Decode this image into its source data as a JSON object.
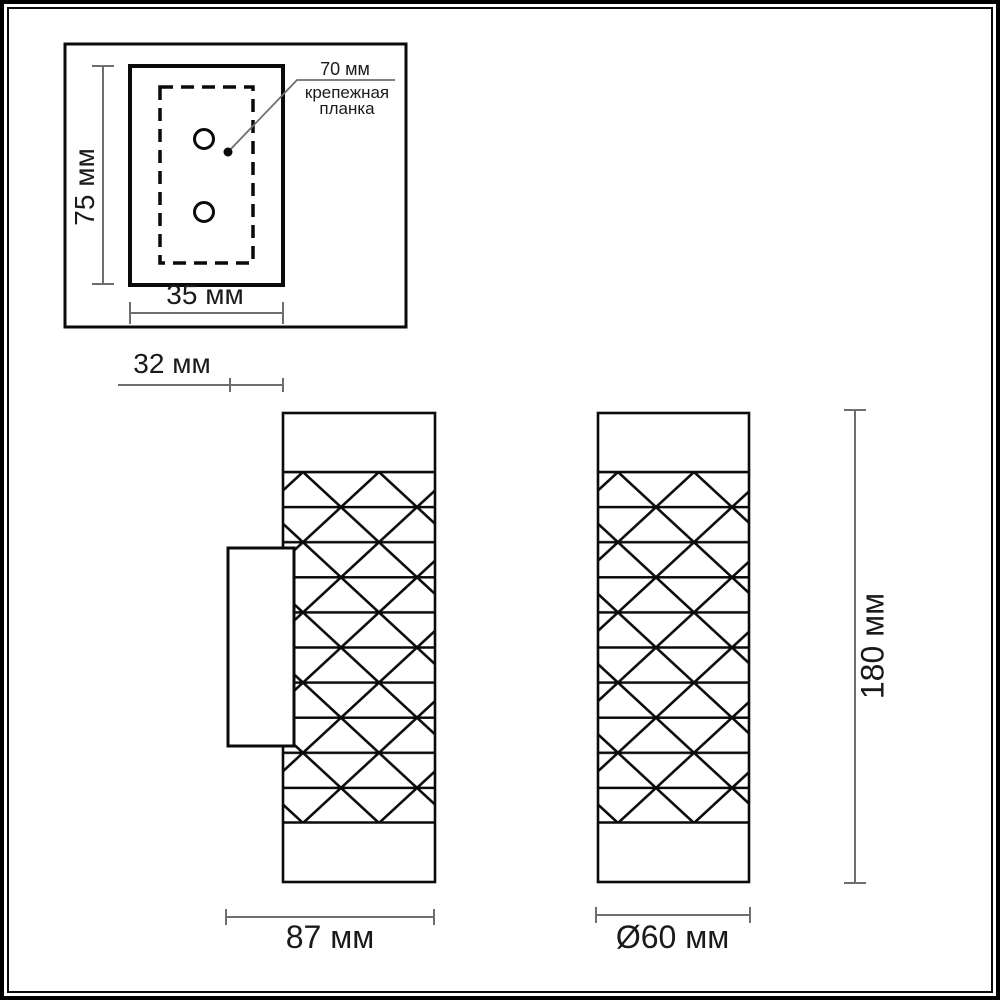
{
  "inset": {
    "plate_height_label": "75 мм",
    "plate_width_label": "35 мм",
    "hole_spacing_label": "70 мм",
    "callout_line1": "крепежная",
    "callout_line2": "планка"
  },
  "side_view": {
    "bracket_depth_label": "32 мм",
    "overall_depth_label": "87 мм"
  },
  "front_view": {
    "diameter_label": "Ø60 мм",
    "height_label": "180 мм"
  },
  "colors": {
    "outline": "#0a0a0a",
    "dimension_line": "#6e6e6e",
    "background": "#ffffff"
  }
}
